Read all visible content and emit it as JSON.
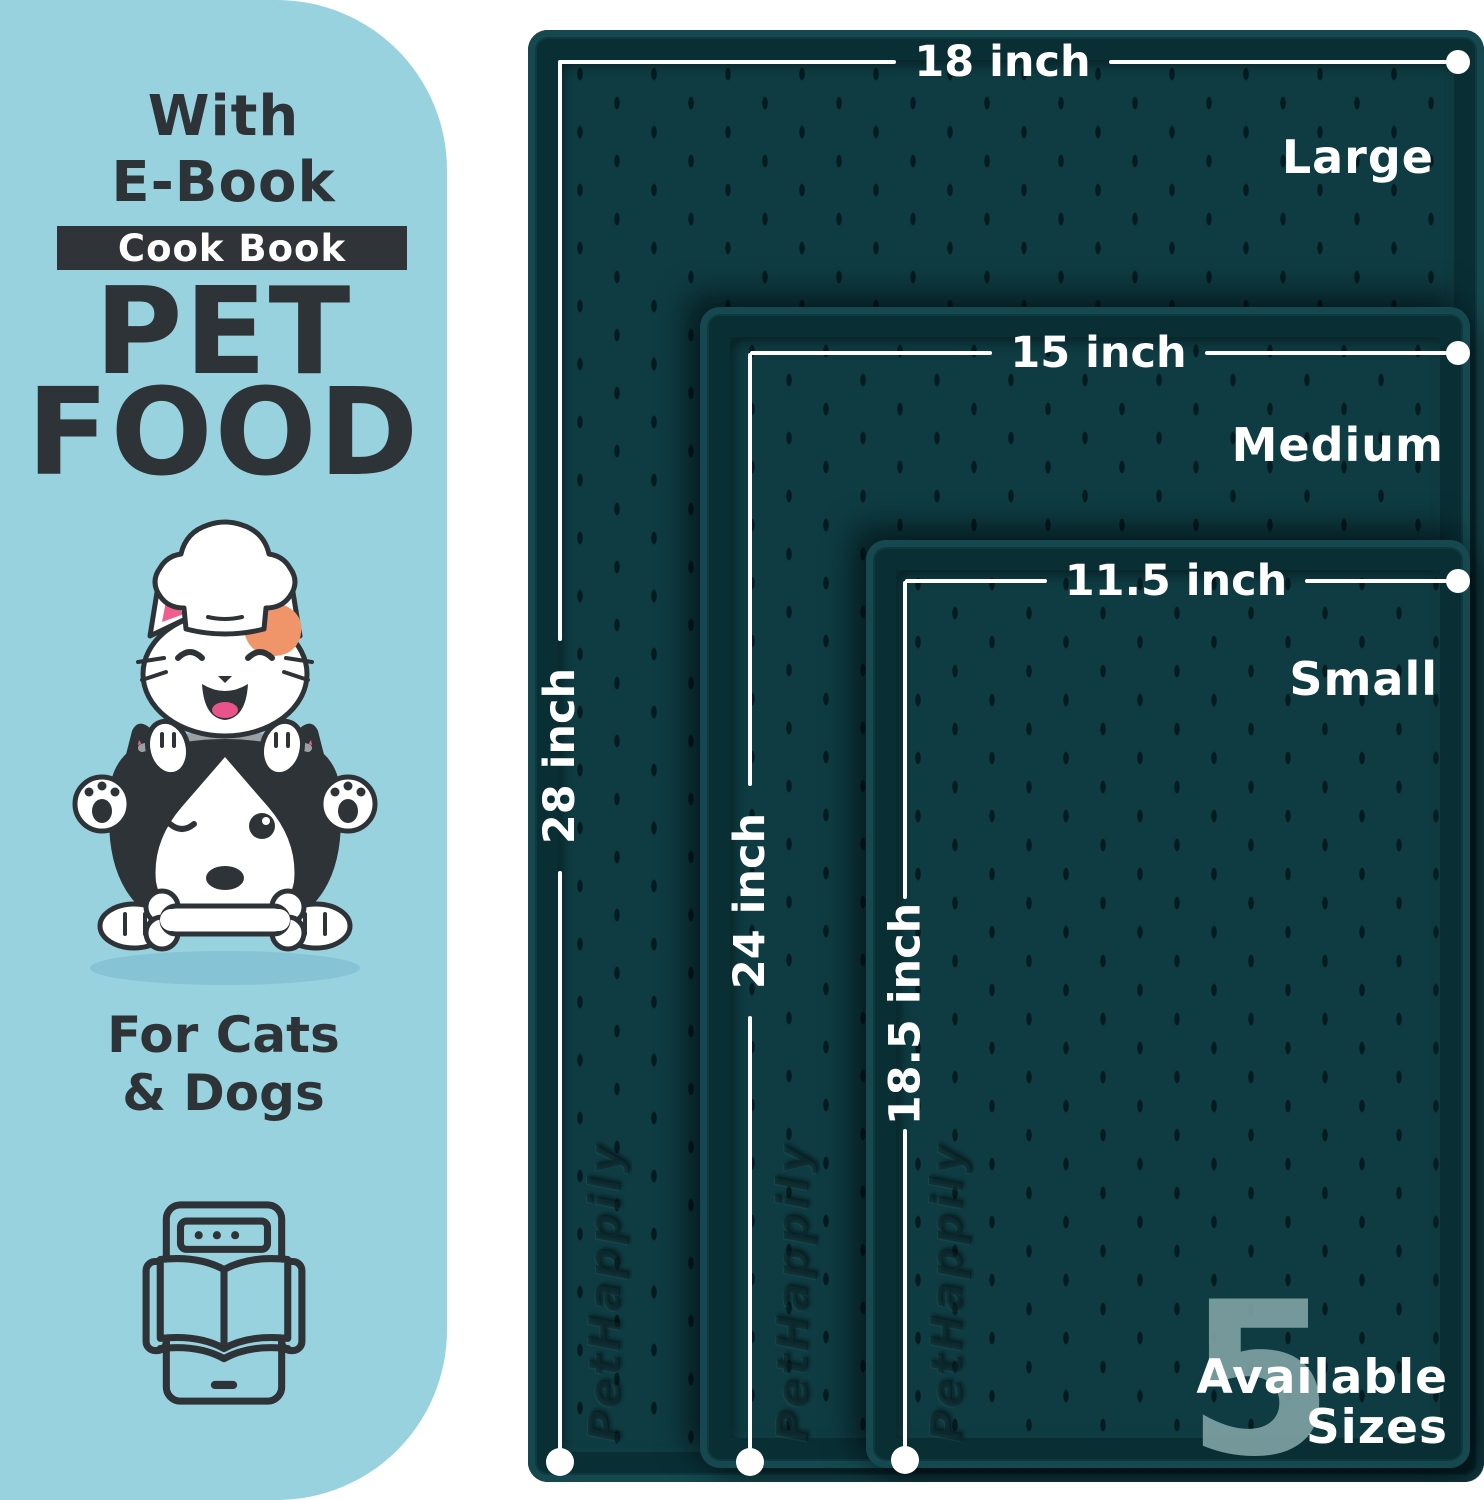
{
  "left_panel": {
    "heading_line1": "With",
    "heading_line2": "E-Book",
    "banner_label": "Cook Book",
    "title_line1": "PET",
    "title_line2": "FOOD",
    "subtitle_line1": "For Cats",
    "subtitle_line2": "& Dogs",
    "illustration": "cat-chef-on-husky-dog-with-bone",
    "icon": "tablet-ebook-open-book"
  },
  "size_chart": {
    "mats": [
      {
        "name": "Large",
        "width_label": "18 inch",
        "length_label": "28 inch"
      },
      {
        "name": "Medium",
        "width_label": "15 inch",
        "length_label": "24 inch"
      },
      {
        "name": "Small",
        "width_label": "11.5 inch",
        "length_label": "18.5 inch"
      }
    ],
    "embossed_logo": "PetHappily",
    "badge": {
      "number": "5",
      "line1": "Available",
      "line2": "Sizes"
    }
  },
  "colors": {
    "panel_bg": "#98d2de",
    "panel_text": "#2e3338",
    "banner_bg": "#303439",
    "banner_text": "#ffffff",
    "mat_surface": "#0e3c42",
    "mat_rim": "#15494f",
    "dimension_line": "#ffffff",
    "badge_number": "#7ea0a2",
    "cat_patch_orange": "#f0956a",
    "ear_pink": "#ef5e8c",
    "tongue_pink": "#e8538c"
  }
}
